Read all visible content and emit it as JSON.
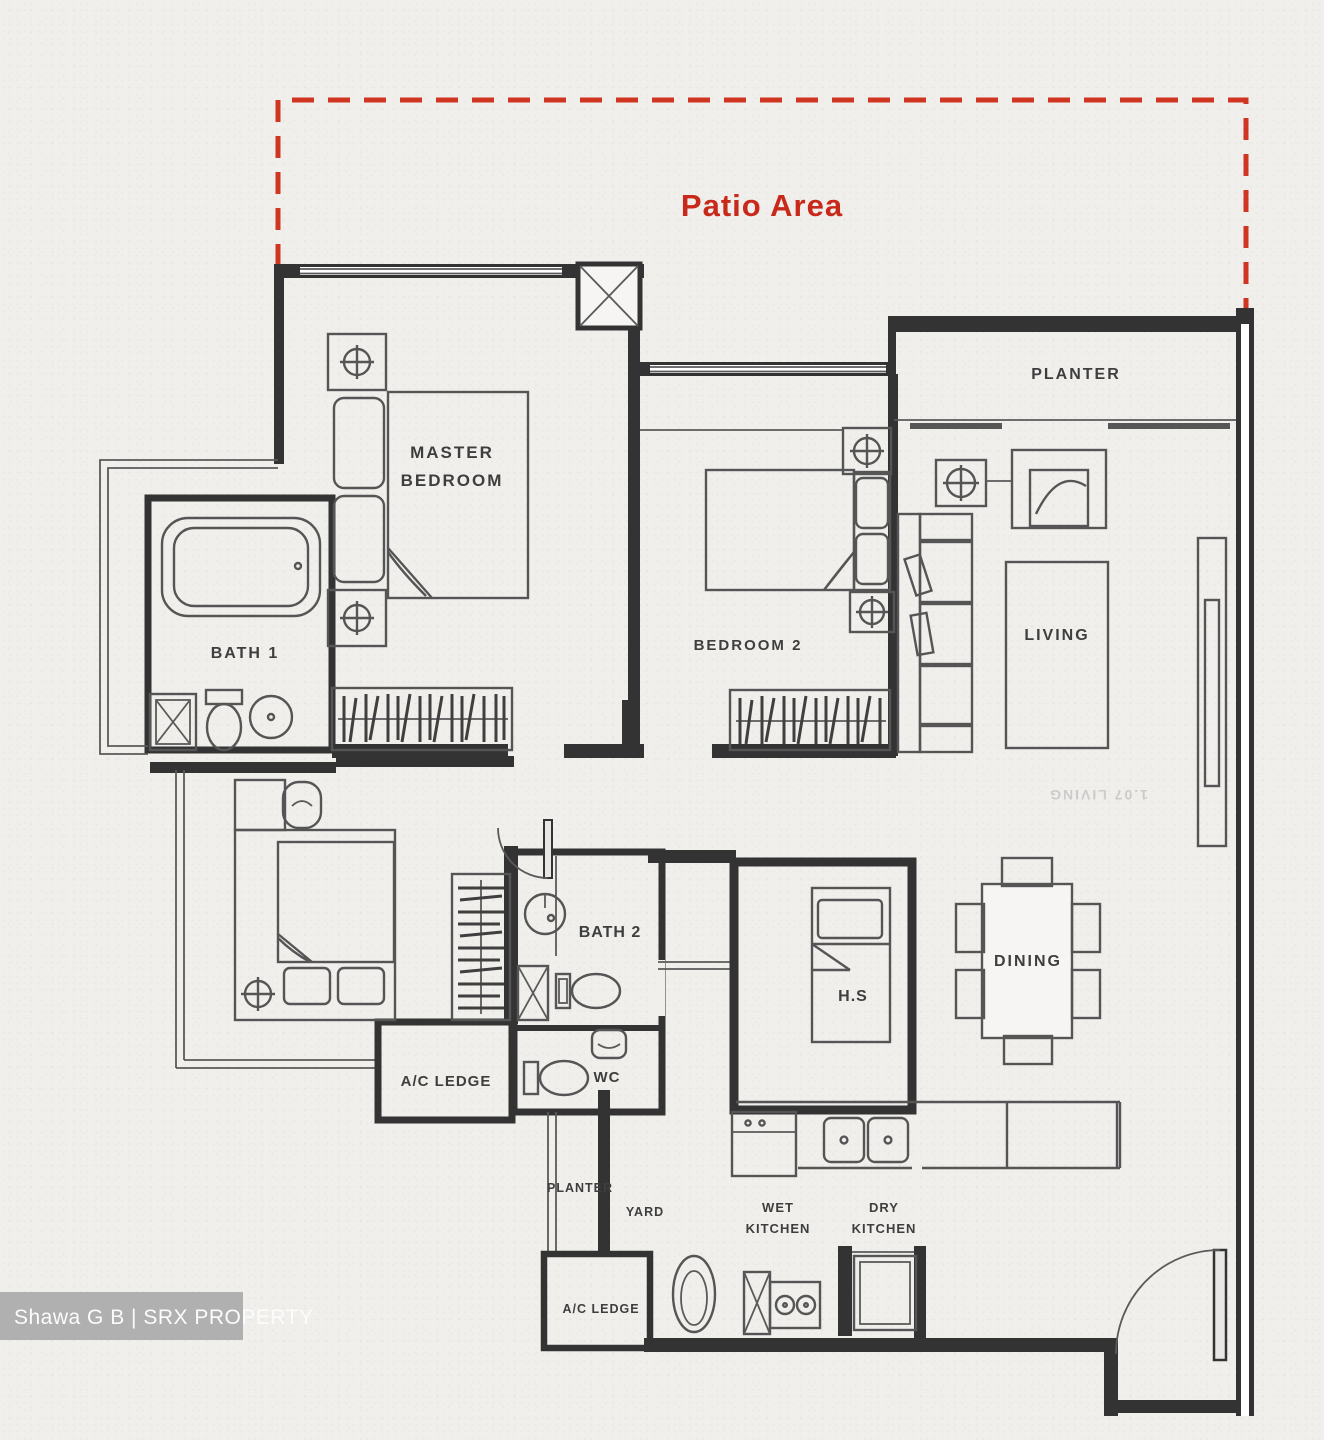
{
  "colors": {
    "patio_red": "#c9291a",
    "wall": "#333333",
    "label": "#3e3e3e",
    "paper": "#f0efec",
    "watermark_bg": "#a2a2a2"
  },
  "patio": {
    "label": "Patio Area"
  },
  "labels": {
    "master_line1": "MASTER",
    "master_line2": "BEDROOM",
    "bath1": "BATH 1",
    "bedroom2": "BEDROOM 2",
    "planter_top": "PLANTER",
    "living": "LIVING",
    "bath2": "BATH 2",
    "wc": "WC",
    "hs": "H.S",
    "dining": "DINING",
    "ac_ledge_left": "A/C LEDGE",
    "ac_ledge_bottom": "A/C LEDGE",
    "planter_bottom": "PLANTER",
    "yard": "YARD",
    "wet_line1": "WET",
    "wet_line2": "KITCHEN",
    "dry_line1": "DRY",
    "dry_line2": "KITCHEN",
    "bleed": "1.07 LIVING"
  },
  "watermark": {
    "text": "Shawa G B | SRX PROPERTY"
  }
}
